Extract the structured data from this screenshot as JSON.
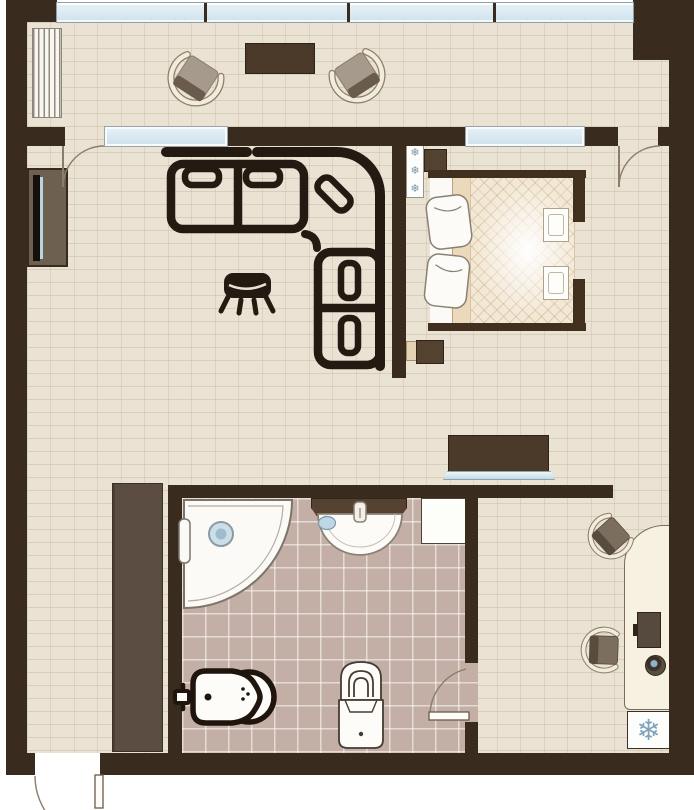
{
  "app": {
    "title": "Apartment floor plan (top-down view)"
  },
  "icons": {
    "snowflake": "❄",
    "radiator_symbol": "snowflake-icon",
    "fridge_symbol": "snowflake-icon"
  },
  "palette": {
    "wall": "#3a2b1f",
    "floor_brick": "#eae2d2",
    "bathroom_tile": "#c3afa5",
    "window_glass": "#d7e8f2",
    "dark_furniture": "#4b3a2a",
    "wardrobe_brown": "#5b4d41",
    "icon_ink": "#241a11",
    "snowflake_blue": "#7fa3bc",
    "bed_duvet": "#f3e8d5"
  },
  "rooms": {
    "balcony": {
      "name": "balcony",
      "items": [
        "radiator",
        "armchair",
        "coffee-table",
        "armchair"
      ]
    },
    "living_area": {
      "name": "living-area",
      "items": [
        "tv-cabinet",
        "corner-sofa",
        "ottoman",
        "radiator"
      ]
    },
    "sleeping_area": {
      "name": "sleeping-area",
      "items": [
        "nightstand",
        "double-bed",
        "pillows",
        "nightstand",
        "sideboard"
      ]
    },
    "hallway": {
      "name": "hallway",
      "items": [
        "wardrobe",
        "entry-door"
      ]
    },
    "bathroom": {
      "name": "bathroom",
      "items": [
        "corner-shower",
        "counter",
        "washbasin",
        "washing-machine",
        "bidet",
        "toilet",
        "door"
      ]
    },
    "work_area": {
      "name": "work-area",
      "items": [
        "desk",
        "monitor",
        "speaker",
        "desk-chair",
        "desk-chair",
        "refrigerator"
      ]
    }
  }
}
